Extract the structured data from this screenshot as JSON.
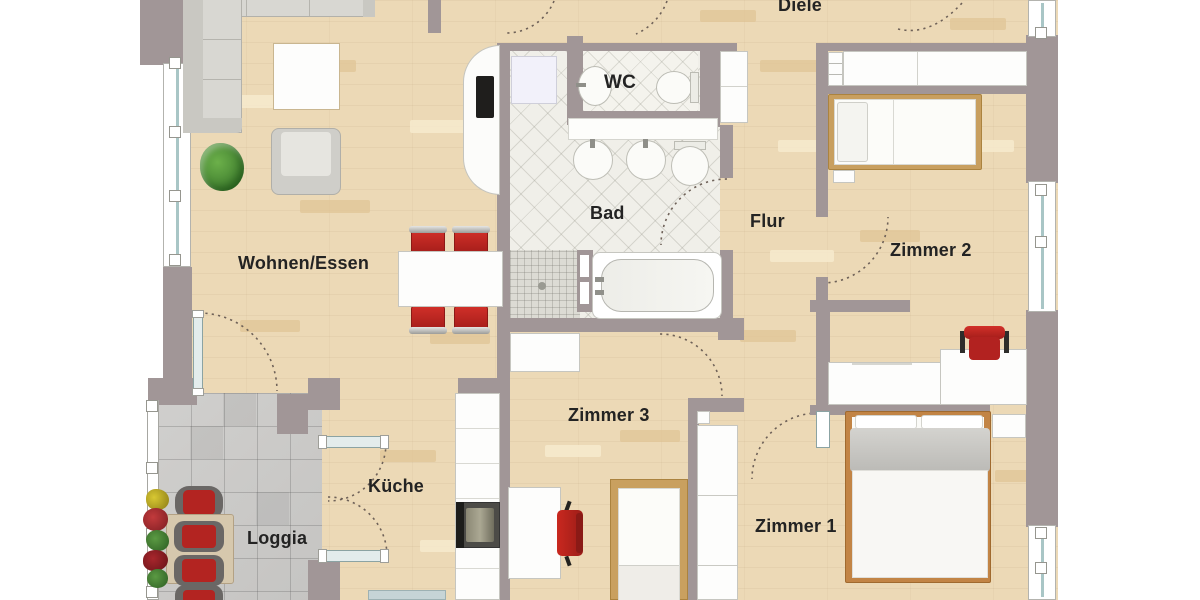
{
  "rooms": {
    "wohnen_essen": "Wohnen/Essen",
    "kueche": "Küche",
    "loggia": "Loggia",
    "bad": "Bad",
    "wc": "WC",
    "diele": "Diele",
    "flur": "Flur",
    "zimmer1": "Zimmer 1",
    "zimmer2": "Zimmer 2",
    "zimmer3": "Zimmer 3"
  },
  "colors": {
    "wall": "#a19697",
    "wood_floor": "#ecd9b6",
    "bath_tile": "#f0efe9",
    "loggia_tile": "#cbcac8",
    "accent_red": "#c32723",
    "bed_frame_tan": "#c89f5f",
    "window_glass": "#a9c6c6",
    "furniture_white": "#fdfdfc",
    "plant_green": "#4e8f3a",
    "label_text": "#232323"
  }
}
